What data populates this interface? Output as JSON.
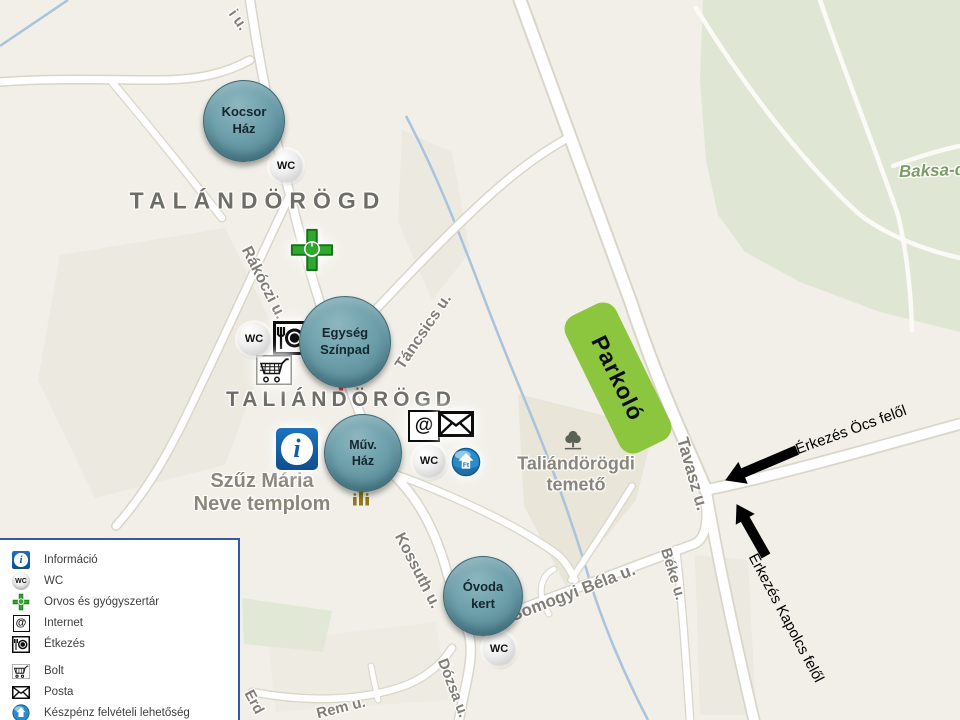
{
  "map": {
    "town_labels": {
      "north": "TALÁNDÖRÖGD",
      "south": "TALIÁNDÖRÖGD"
    },
    "streets": {
      "top_partial": "i u.",
      "rakoczi": "Rákóczi u.",
      "tancsics": "Táncsics u.",
      "kossuth": "Kossuth u.",
      "somogyi": "Somogyi Béla u.",
      "beke": "Béke u.",
      "dozsa": "Dózsa u.",
      "tavasz": "Tavasz u.",
      "rem": "Rem u.",
      "erd_partial": "Erd",
      "baksa_partial": "Baksa-d"
    },
    "places": {
      "church": {
        "line1": "Szűz Mária",
        "line2": "Neve templom"
      },
      "cemetery": {
        "line1": "Taliándörögdi",
        "line2": "temető"
      }
    }
  },
  "venues": {
    "kocsor": {
      "line1": "Kocsor",
      "line2": "Ház"
    },
    "egyseg": {
      "line1": "Egység",
      "line2": "Színpad"
    },
    "muv": {
      "line1": "Műv.",
      "line2": "Ház"
    },
    "ovoda": {
      "line1": "Óvoda",
      "line2": "kert"
    }
  },
  "badges": {
    "wc": "WC"
  },
  "parking": {
    "label": "Parkoló"
  },
  "arrows": {
    "ocs": "Érkezés Öcs felől",
    "kapolcs": "Érkezés Kapolcs felől"
  },
  "icons": {
    "at_char": "@",
    "info_char": "i",
    "atm_char": "Ft"
  },
  "legend": {
    "items": [
      {
        "icon": "info-icon",
        "label": "Információ"
      },
      {
        "icon": "wc-icon",
        "label": "WC"
      },
      {
        "icon": "pharmacy-cross-icon",
        "label": "Orvos és gyógyszertár"
      },
      {
        "icon": "internet-at-icon",
        "label": "Internet"
      },
      {
        "icon": "food-icon",
        "label": "Étkezés"
      },
      {
        "icon": "shop-cart-icon",
        "label": "Bolt"
      },
      {
        "icon": "post-envelope-icon",
        "label": "Posta"
      },
      {
        "icon": "atm-globe-icon",
        "label": "Készpénz felvételi lehetőség"
      }
    ]
  },
  "colors": {
    "venue_circle": "#6da0ab",
    "parking_green": "#8cc63f",
    "legend_border": "#35599e",
    "pin_red": "#e8453c",
    "map_background": "#f1efe8",
    "green_area": "#dfe6d4"
  }
}
